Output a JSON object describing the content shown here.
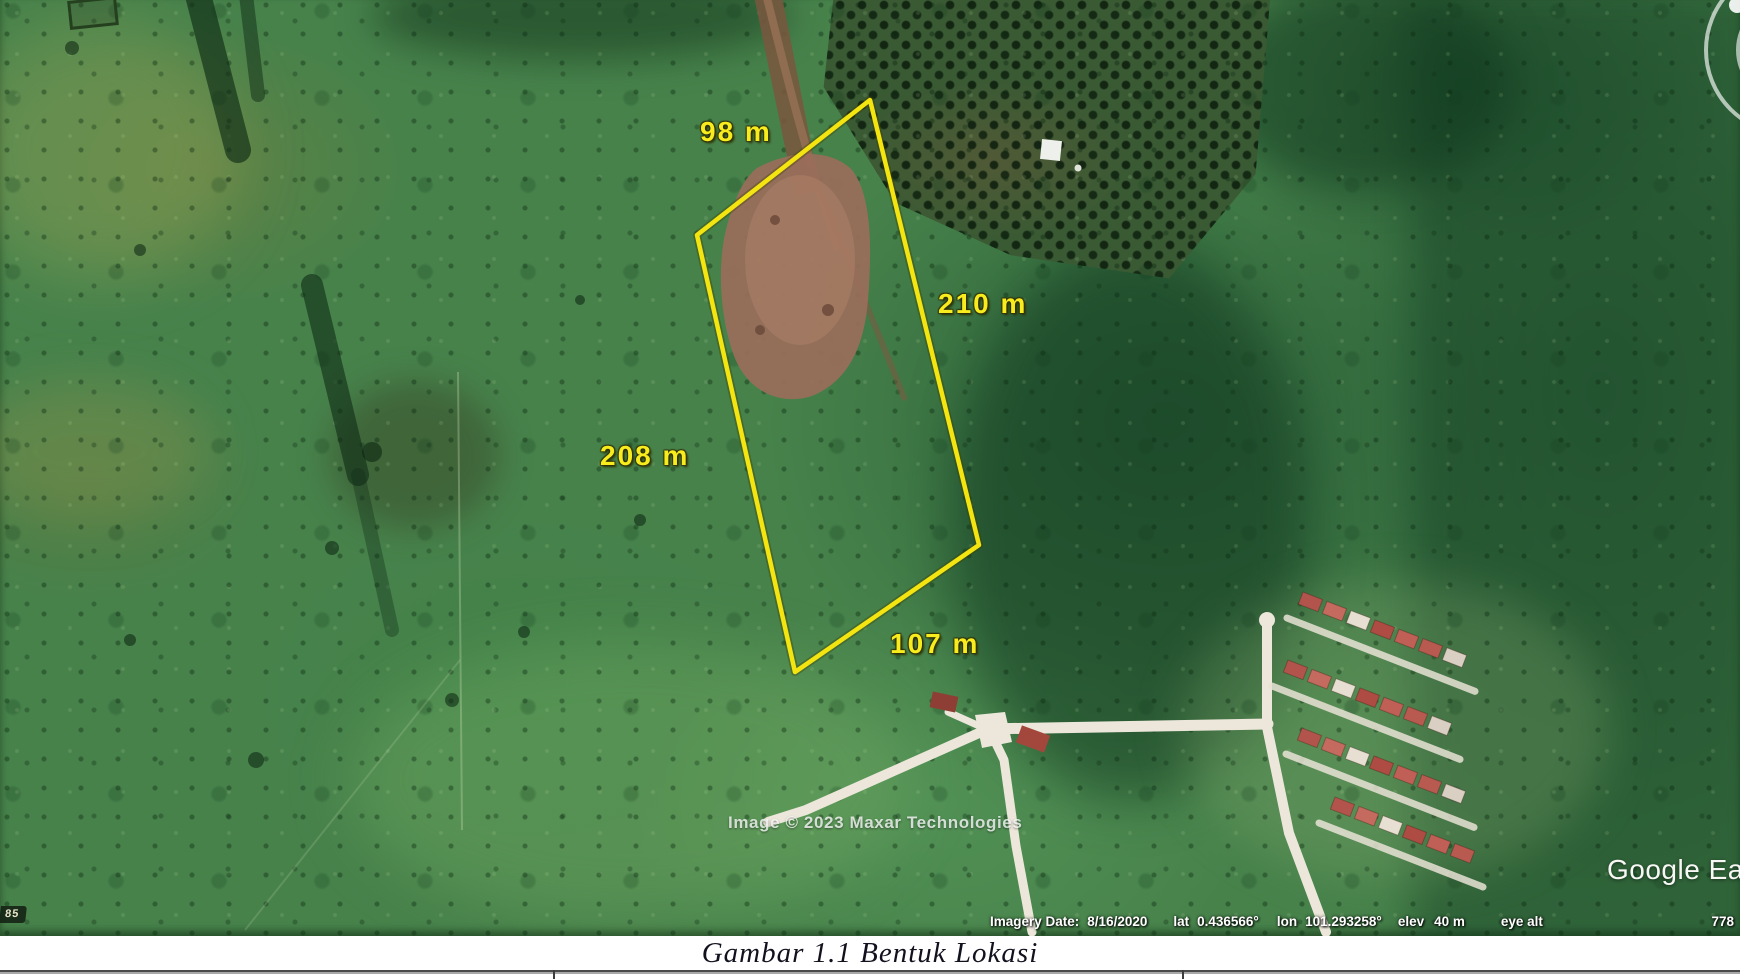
{
  "map_overlay": {
    "measurement_top": "98 m",
    "measurement_right": "210 m",
    "measurement_left": "208 m",
    "measurement_bottom": "107 m",
    "imagery_watermark": "Image © 2023 Maxar Technologies",
    "logo_text": "Google Ea",
    "corner_badge": "85"
  },
  "status_bar": {
    "imagery_date_label": "Imagery Date:",
    "imagery_date_value": "8/16/2020",
    "lat_label": "lat",
    "lat_value": "0.436566°",
    "lon_label": "lon",
    "lon_value": "101.293258°",
    "elev_label": "elev",
    "elev_value": "40 m",
    "eye_alt_label": "eye alt",
    "eye_alt_value": "778"
  },
  "caption": "Gambar 1.1 Bentuk Lokasi",
  "colors": {
    "plot_outline": "#f4e410",
    "measurement_text": "#f8ec1e",
    "house_roof": "#b2544c",
    "road": "#ece7da"
  }
}
